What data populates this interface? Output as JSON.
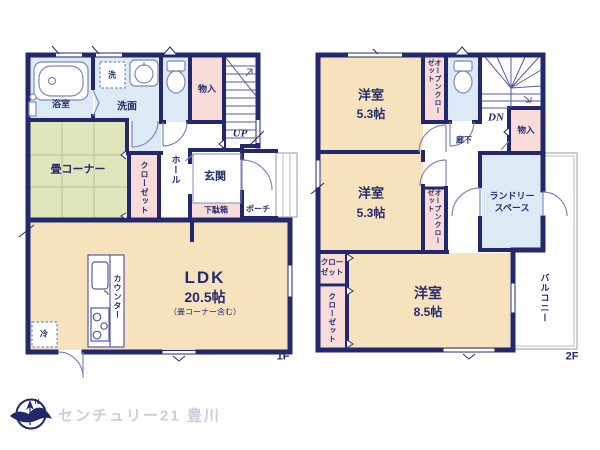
{
  "floor1": {
    "label": "1F",
    "bath": "浴室",
    "washer_symbol": "洗",
    "washroom": "洗面",
    "storage": "物入",
    "stairs_up": "UP",
    "tatami_corner": "畳コーナー",
    "closet": "クローゼット",
    "hall": "ホール",
    "entrance": "玄関",
    "shoe_box": "下駄箱",
    "porch": "ポーチ",
    "ldk": "LDK",
    "ldk_size": "20.5帖",
    "ldk_note": "（畳コーナー含む）",
    "counter": "カウンター",
    "fridge": "冷"
  },
  "floor2": {
    "label": "2F",
    "bedroom1": "洋室",
    "bedroom1_size": "5.3帖",
    "open_closet1": "オープンクローゼット",
    "stairs_down": "DN",
    "corridor": "廊下",
    "storage": "物入",
    "bedroom2": "洋室",
    "bedroom2_size": "5.3帖",
    "open_closet2": "オープンクローゼット",
    "laundry_line1": "ランドリー",
    "laundry_line2": "スペース",
    "closet_small_line1": "クロー",
    "closet_small_line2": "ゼット",
    "closet_tall": "クローゼット",
    "bedroom3": "洋室",
    "bedroom3_size": "8.5帖",
    "balcony": "バルコニー"
  },
  "footer": {
    "compass_n": "N",
    "brand": "センチュリー21 豊川"
  },
  "colors": {
    "wall_navy": "#23276b",
    "room_cream": "#f6e3bd",
    "tatami_green": "#e0e6bc",
    "wet_area_blue": "#dceaf5",
    "closet_pink": "#f9dcd7",
    "fixture_line": "#8087bb",
    "outside_gray": "#b7bac8",
    "label_navy": "#262b6e",
    "brand_gray": "#cbcdd9"
  }
}
